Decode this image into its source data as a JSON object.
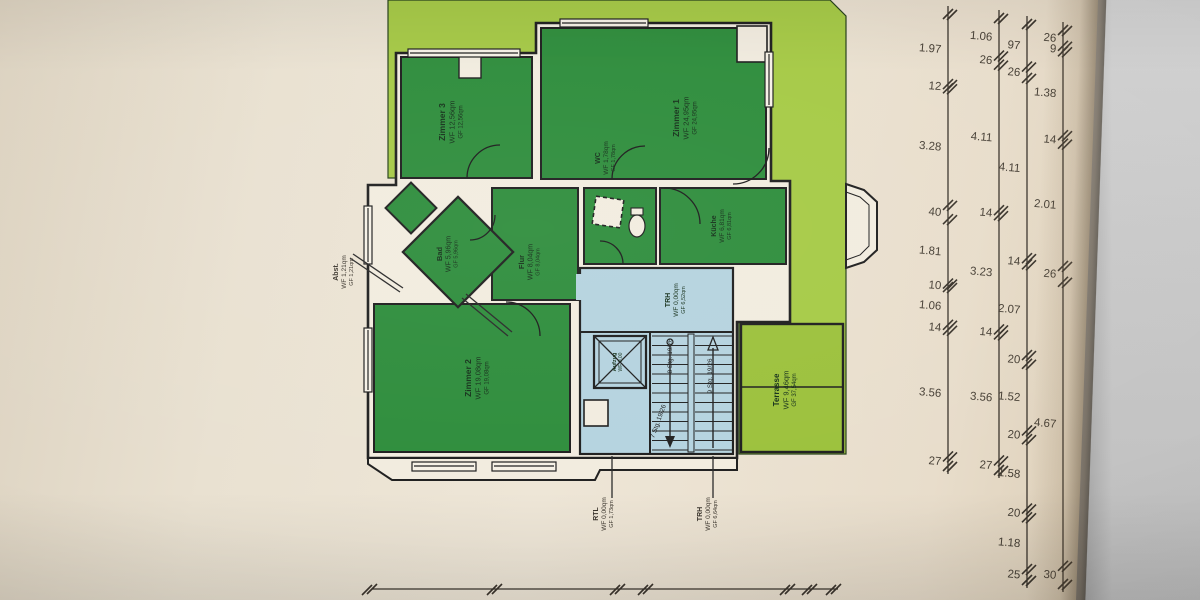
{
  "title": "Wohnungs-Grundriss (Foto eines Bauplans)",
  "rooms": [
    {
      "name": "Zimmer 3",
      "wf": "WF 12,56qm",
      "gf": "GF 12,56qm"
    },
    {
      "name": "Zimmer 1",
      "wf": "WF 24,95qm",
      "gf": "GF 24,95qm"
    },
    {
      "name": "WC",
      "wf": "WF 1,78qm",
      "gf": "GF 1,78qm"
    },
    {
      "name": "Küche",
      "wf": "WF 6,81qm",
      "gf": "GF 6,81qm"
    },
    {
      "name": "Flur",
      "wf": "WF 8,04qm",
      "gf": "GF 8,04qm"
    },
    {
      "name": "Bad",
      "wf": "WF 5,96qm",
      "gf": "GF 5,96qm"
    },
    {
      "name": "Zimmer 2",
      "wf": "WF 19,08qm",
      "gf": "GF 19,08qm"
    },
    {
      "name": "Terrasse",
      "wf": "WF 9,46qm",
      "gf": "GF 37,54qm"
    },
    {
      "name": "TRH",
      "wf": "WF 0,00qm",
      "gf": "GF 6,52qm"
    },
    {
      "name": "Abst.",
      "wf": "WF 1,21qm",
      "gf": "GF 1,21qm"
    },
    {
      "name": "Aufzug",
      "wf": "WF 0,00",
      "gf": ""
    },
    {
      "name": "RTL",
      "wf": "WF 0,00qm",
      "gf": "GF 1,73qm"
    },
    {
      "name": "TRH",
      "wf": "WF 0,00qm",
      "gf": "GF 6,64qm"
    }
  ],
  "stairs": {
    "flight_a": "8 Stg. 19/26",
    "flight_b": "9 Stg. 19/26",
    "flight_c": "7 Stg. 19/26"
  },
  "dim_chains": [
    {
      "values": [
        "1.97",
        "12",
        "3.28",
        "40",
        "1.81",
        "10",
        "1.06",
        "14",
        "3.56",
        "27"
      ]
    },
    {
      "values": [
        "1.06",
        "26",
        "4.11",
        "14",
        "3.23",
        "14",
        "3.56",
        "27"
      ]
    },
    {
      "values": [
        "97",
        "26",
        "4.11",
        "14",
        "2.07",
        "20",
        "1.52",
        "20",
        "1.58",
        "20",
        "1.18",
        "25"
      ]
    },
    {
      "values": [
        "26",
        "9",
        "1.38",
        "14",
        "2.01",
        "26",
        "4.67",
        "30"
      ]
    }
  ],
  "colors": {
    "room_green": "#2e8d3c",
    "band_green": "#a6ca46",
    "terrace_green": "#9cc13c",
    "stair_blue": "#b5d3df",
    "plan_white": "#f2ecdf",
    "wall": "#1f1f1f"
  }
}
